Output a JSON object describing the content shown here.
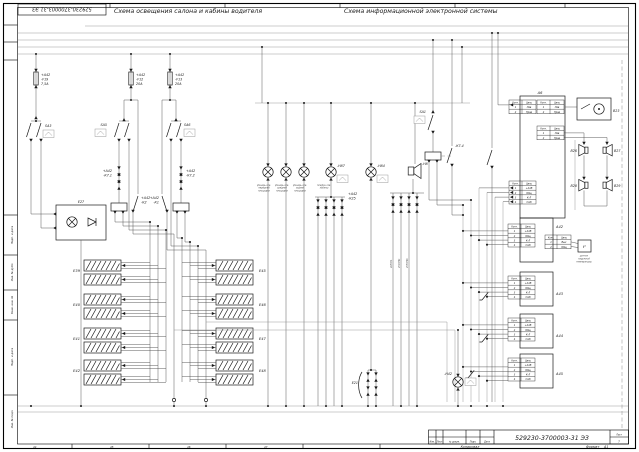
{
  "titles": {
    "stamp": "529230-3700003-31 ЭЗ",
    "left": "Схема освещения салона и кабины водителя",
    "right": "Схема информационной электронной системы"
  },
  "left": {
    "fuses": [
      [
        "+А42",
        "-F19",
        "7,5А"
      ],
      [
        "+А42",
        "-F12",
        "20А"
      ],
      [
        "+А42",
        "-F13",
        "20А"
      ]
    ],
    "switches": [
      "SA3",
      "SA5",
      "SA6"
    ],
    "relay1": [
      "+А42",
      "-К7.1"
    ],
    "relay2": [
      "+А42",
      "-К7.2"
    ],
    "contact1": [
      "+А42",
      "-К2"
    ],
    "contact2": [
      "+А42",
      "-К1"
    ],
    "e27": "Е27",
    "mods_l": [
      "Е39",
      "Е40",
      "Е41",
      "Е42"
    ],
    "mods_r": [
      "Е45",
      "Е46",
      "Е47",
      "Е48"
    ]
  },
  "mid": {
    "caps": [
      [
        "фонарь осв.",
        "передней",
        "площадки"
      ],
      [
        "фонарь осв.",
        "средней",
        "площадки"
      ],
      [
        "фонарь осв.",
        "задней",
        "площадки"
      ],
      [
        "плафон осв.",
        "кабины"
      ]
    ],
    "h87": "-Н87",
    "h84": "-Н84",
    "h8": "-Н8",
    "h42": "-Н42",
    "diode1": [
      "+А42",
      "-К25"
    ],
    "e21": "Е21",
    "wires": [
      "405ГРА",
      "451ГР91",
      "455ГР96"
    ]
  },
  "right": {
    "sa1": "SA1",
    "k74": "-К7.4",
    "a6": "А6",
    "b23": "В23",
    "spk": [
      "В26",
      "В27",
      "В28",
      "В29"
    ],
    "hdr": [
      "Конт.",
      "Цепь"
    ],
    "a6rows": [
      [
        "1",
        "Лев"
      ],
      [
        "2",
        "Прав"
      ]
    ],
    "prows": [
      [
        "1",
        "+24В"
      ],
      [
        "2",
        "Общ"
      ],
      [
        "3",
        "К-Л"
      ],
      [
        "4",
        "CAN"
      ]
    ],
    "srows": [
      [
        "1",
        "Вых"
      ],
      [
        "2",
        "Общ"
      ]
    ],
    "blocks": [
      "А42",
      "А43",
      "А44",
      "А45"
    ],
    "tsym": "t°",
    "sensor": [
      "датчик",
      "наружной",
      "температуры"
    ]
  },
  "frame": {
    "side": [
      "Подп. и дата",
      "Инв. № дубл.",
      "Взам. инв. №",
      "Подп. и дата",
      "Инв. № подл."
    ],
    "tb": {
      "doc": "529230-3700003-31 ЭЗ",
      "izm": "Изм.",
      "list": "Лист",
      "ndoc": "№ докум.",
      "podp": "Подп.",
      "data": "Дата",
      "kop": "Копировал",
      "fmt": "Формат",
      "fmtv": "А1",
      "listv": "7"
    },
    "zones": [
      "44",
      "45",
      "46",
      "47"
    ]
  }
}
